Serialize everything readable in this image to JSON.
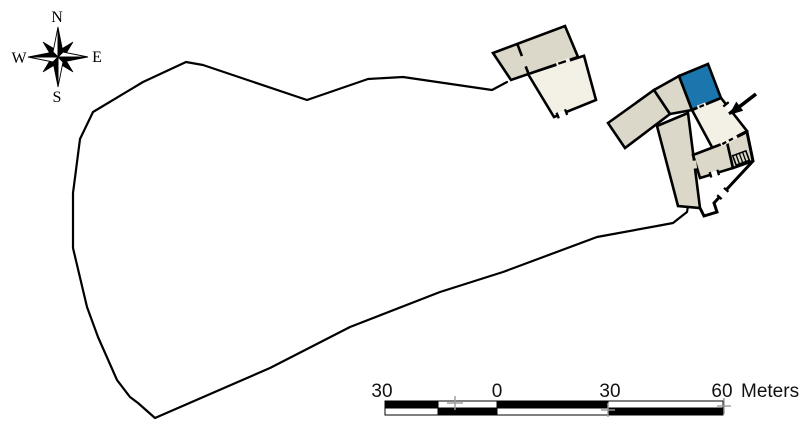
{
  "compass": {
    "north": "N",
    "east": "E",
    "south": "S",
    "west": "W"
  },
  "scale_bar": {
    "tick_labels": [
      "30",
      "0",
      "30",
      "60"
    ],
    "unit_label": "Meters",
    "major_interval_meters": 30,
    "total_span_meters": 90
  },
  "colors": {
    "room_fill": "#dbd8ca",
    "room_fill_light": "#f3f0e6",
    "highlight": "#1b76ae",
    "boundary": "#000000",
    "tick": "#9a9a9a",
    "background": "#ffffff"
  },
  "features": {
    "compass_rose": "compass-rose",
    "site_boundary": "site-boundary",
    "north_building": "north-building",
    "main_building": "main-building-complex",
    "highlighted_room": "highlighted-room",
    "entrance_arrow": "entrance-arrow",
    "stairs": "stairs"
  }
}
